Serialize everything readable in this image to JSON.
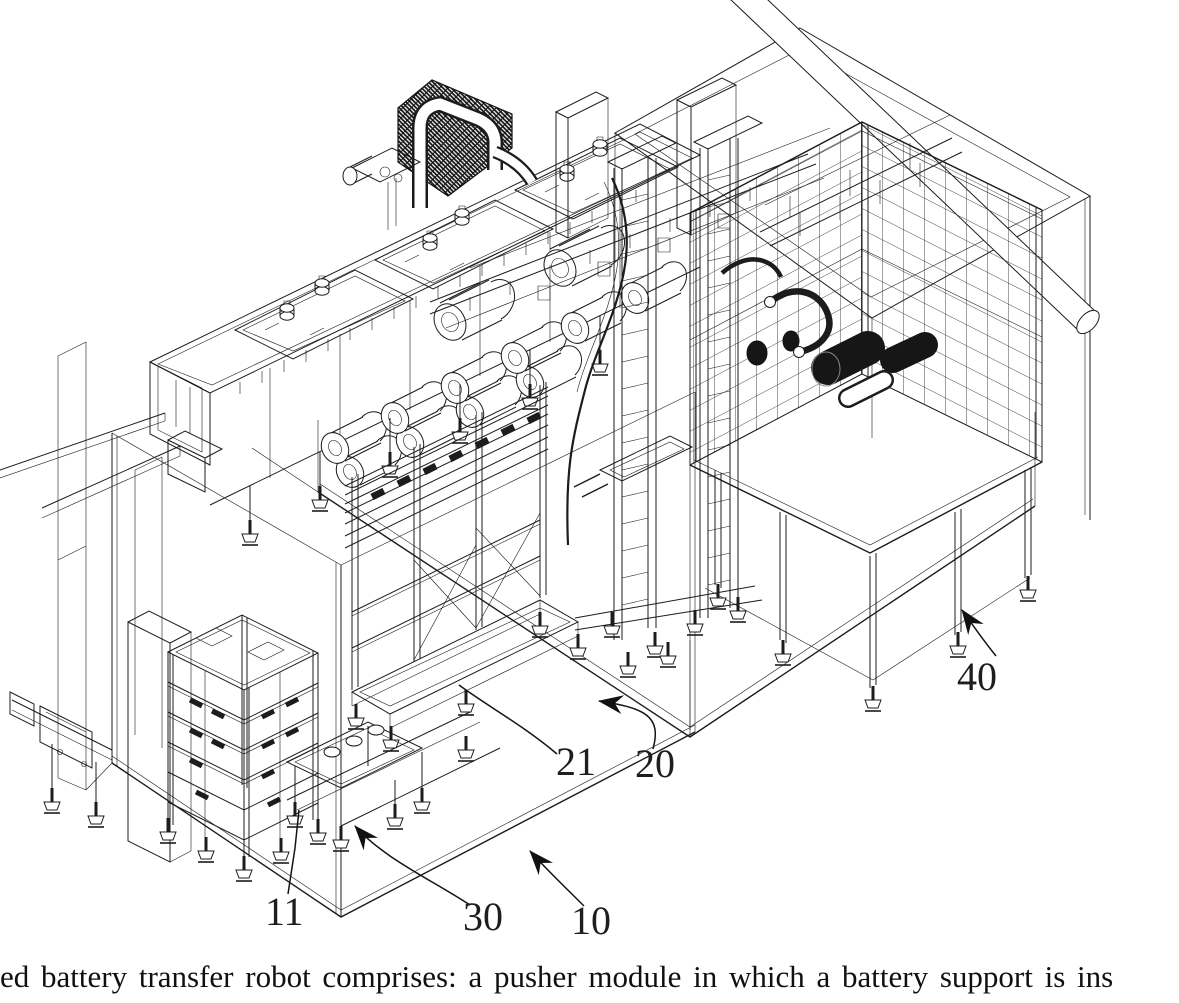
{
  "figure": {
    "type": "patent isometric line drawing of a battery transfer robot system",
    "background_color": "#ffffff",
    "ink_color": "#1c1c1c",
    "motor_fill_color": "#161616"
  },
  "reference_labels": [
    {
      "text": "10",
      "points_to": "lower transparent enclosure box edge"
    },
    {
      "text": "11",
      "points_to": "stacked rack module feet"
    },
    {
      "text": "20",
      "points_to": "transfer robot floor frame edge"
    },
    {
      "text": "21",
      "points_to": "pusher module frame"
    },
    {
      "text": "30",
      "points_to": "cart / conveyor module"
    },
    {
      "text": "40",
      "points_to": "outer room enclosure frame"
    }
  ],
  "caption": {
    "text": "ed battery transfer robot comprises: a pusher module in which a battery support is ins"
  }
}
